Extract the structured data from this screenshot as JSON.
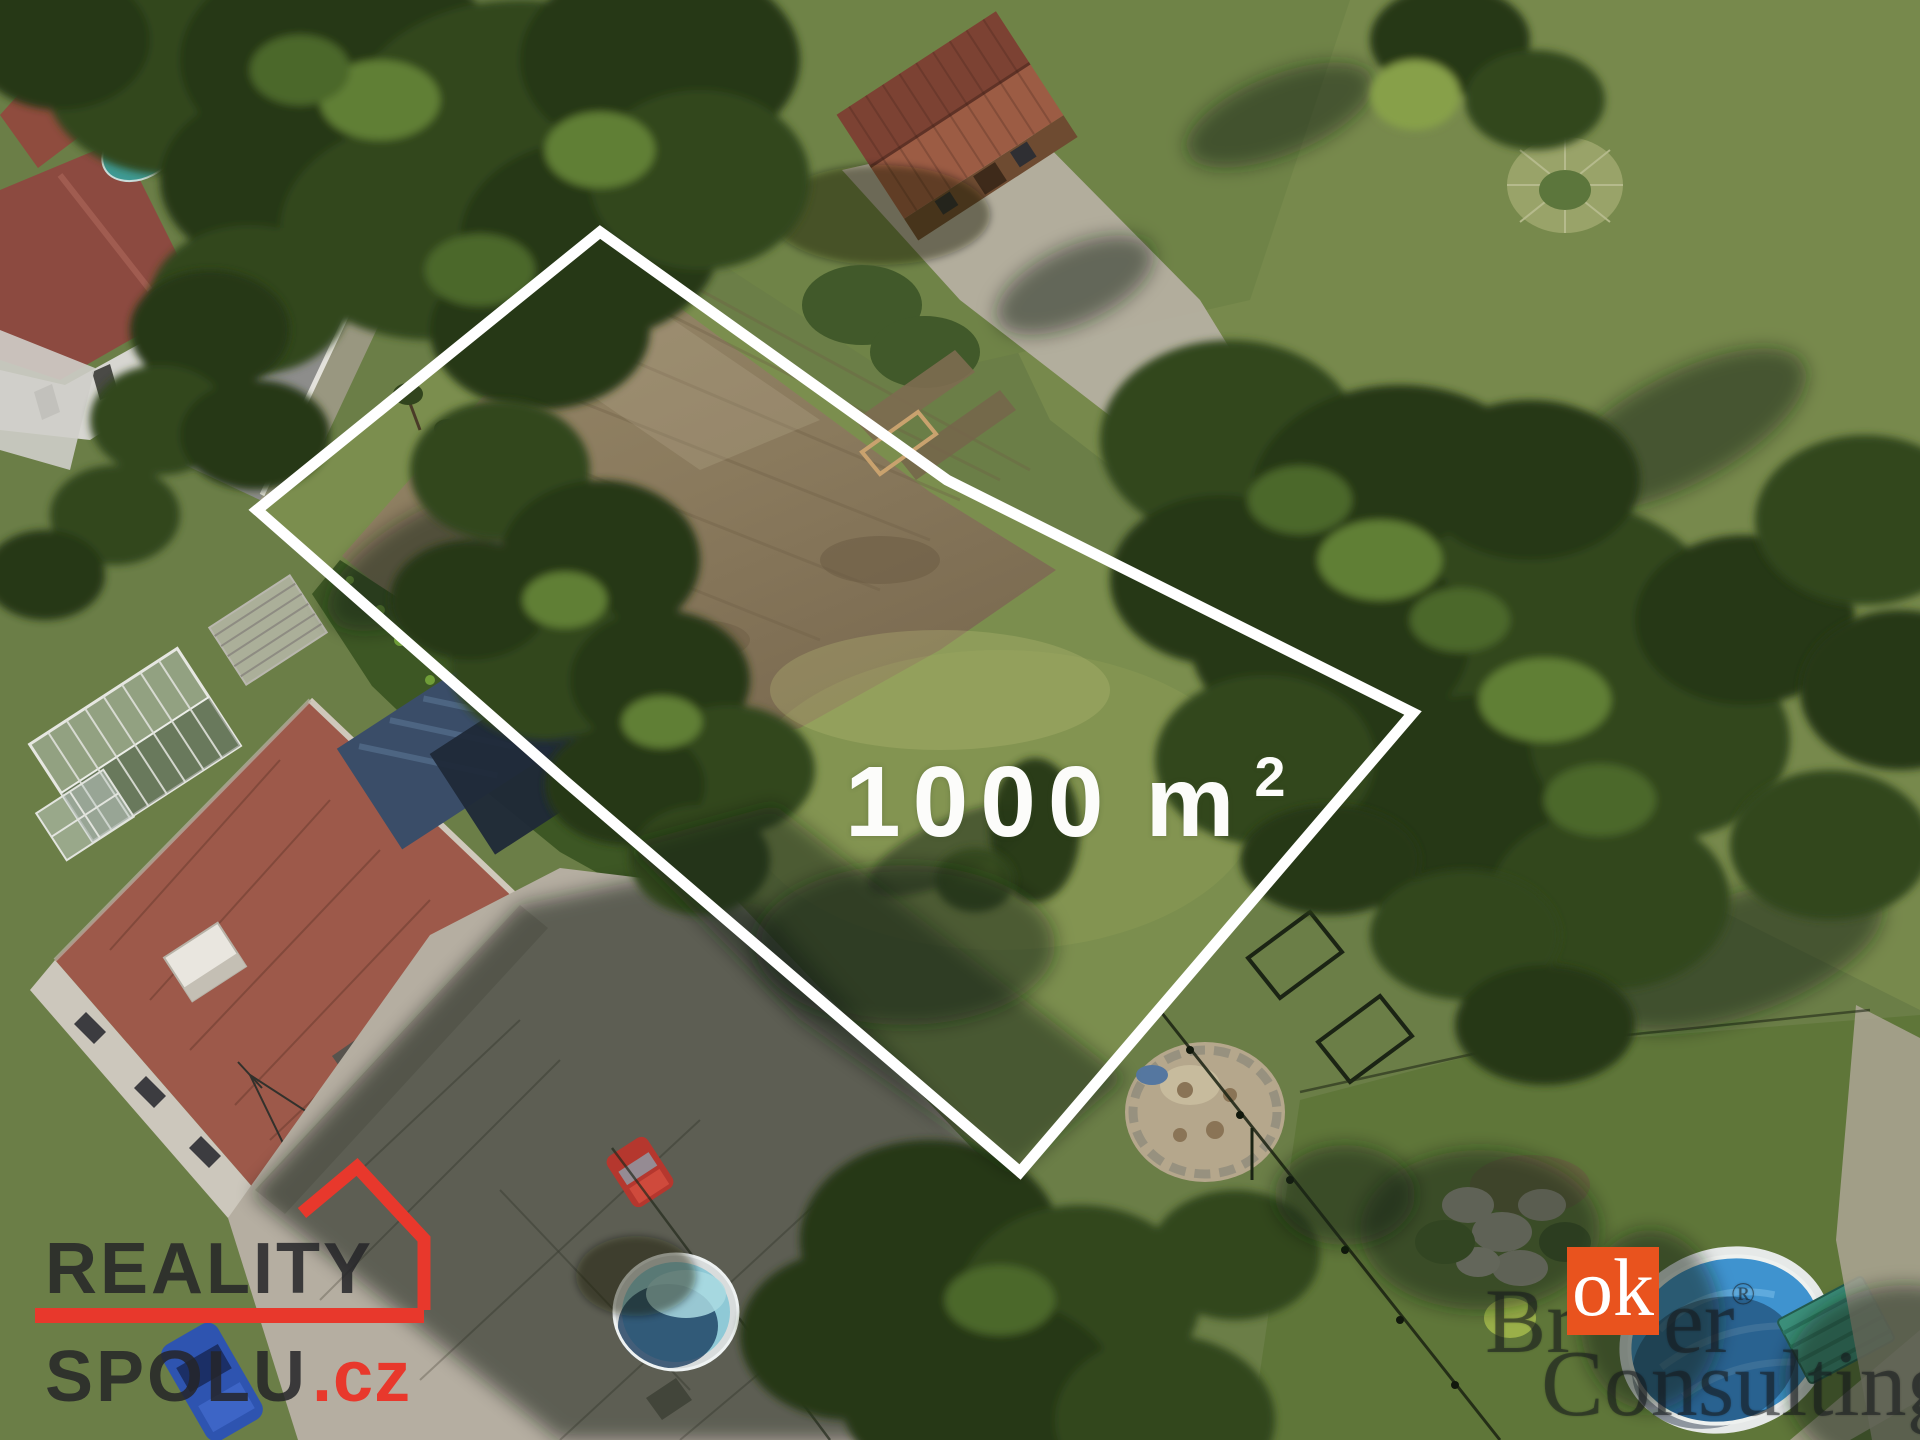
{
  "area_label": {
    "number": "1000",
    "unit": "m",
    "superscript": "2"
  },
  "watermarks": {
    "reality_spolu": {
      "line1": "REALITY",
      "line2": "SPOLU",
      "tld": ".cz",
      "accent_color": "#e8382c",
      "text_color": "rgba(36,36,40,0.85)"
    },
    "broker_consulting": {
      "prefix": "Br",
      "highlight": "ok",
      "suffix": "er",
      "registered": "®",
      "line2": "Consulting",
      "highlight_bg": "#e9531e",
      "highlight_text_color": "#ffffff"
    }
  },
  "plot": {
    "outline_color": "#ffffff"
  }
}
